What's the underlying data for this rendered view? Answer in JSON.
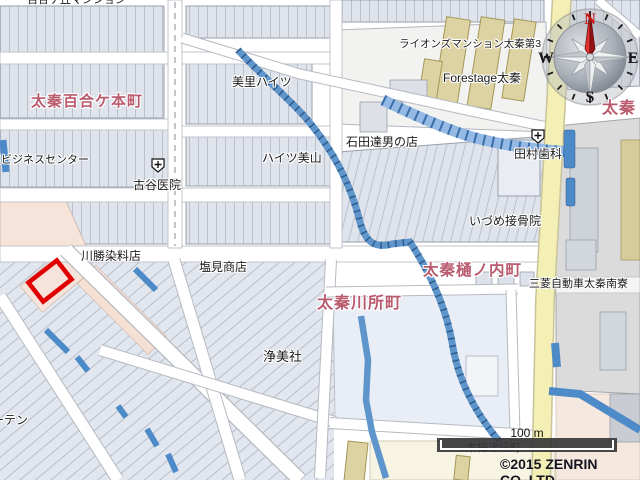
{
  "map": {
    "town_labels": [
      {
        "text": "太秦百合ケ本町"
      },
      {
        "text": "太秦樋ノ内町"
      },
      {
        "text": "太秦川所町"
      },
      {
        "text": "太秦"
      }
    ],
    "place_labels": [
      {
        "text": "百合ケ丘マンション"
      },
      {
        "text": "美里ハイツ"
      },
      {
        "text": "ハイツ美山"
      },
      {
        "text": "栄ビジネスセンター"
      },
      {
        "text": "古谷医院"
      },
      {
        "text": "石田達男の店"
      },
      {
        "text": "ライオンズマンション太秦第3"
      },
      {
        "text": "Forestage太秦"
      },
      {
        "text": "田村歯科"
      },
      {
        "text": "いづめ接骨院"
      },
      {
        "text": "三菱自動車太秦南寮"
      },
      {
        "text": "川勝染料店"
      },
      {
        "text": "塩見商店"
      },
      {
        "text": "浄美社"
      },
      {
        "text": "ーテン"
      },
      {
        "text": "本梅津段町"
      }
    ],
    "compass": {
      "north": "N",
      "east": "E",
      "south": "S",
      "west": "W"
    },
    "scale_bar_label": "100 m",
    "attribution": "©2015 ZENRIN CO.,LTD.",
    "colors": {
      "parcel_fill": "#dfe3eb",
      "parcel_line": "#bcc0ca",
      "road_edge": "#b4b8c0",
      "yellow_road": "#f3efb5",
      "river_blue": "#5e95cb",
      "river_dark": "#2f5a8c",
      "factory_gray": "#dbdbdb",
      "building_tan": "#ddd3a2",
      "zone_peach": "#f6e3da",
      "zone_cream": "#f7f4e4",
      "kawasho_fill": "#e9eef6",
      "highlight_red": "#e10000",
      "town_label": "#ba5a6e"
    }
  }
}
